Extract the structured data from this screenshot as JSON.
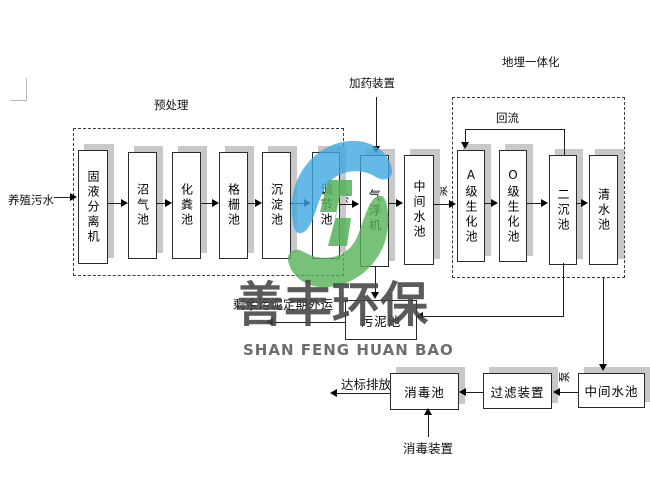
{
  "labels": {
    "source": "养殖污水",
    "pretreatment": "预处理",
    "dosing": "加药装置",
    "buried": "地埋一体化",
    "reflux": "回流",
    "pump": "泵",
    "sludge_note": "剩余污泥定期外运",
    "discharge": "达标排放",
    "disinfect_device": "消毒装置"
  },
  "stages": [
    {
      "label": "固液分离机"
    },
    {
      "label": "沼气池"
    },
    {
      "label": "化粪池"
    },
    {
      "label": "格栅池"
    },
    {
      "label": "沉淀池"
    },
    {
      "label": "调节池"
    },
    {
      "label": "气浮机"
    },
    {
      "label": "中间水池"
    },
    {
      "label": "A级生化池"
    },
    {
      "label": "O级生化池"
    },
    {
      "label": "二沉池"
    },
    {
      "label": "清水池"
    }
  ],
  "boxes": {
    "sludge": "污泥池",
    "disinfection": "消毒池",
    "filter": "过滤装置",
    "intermediate2": "中间水池"
  },
  "watermark": {
    "cn": "善丰环保",
    "en": "SHAN FENG HUAN BAO",
    "blue": "#3fa7e1",
    "green": "#56b259"
  }
}
